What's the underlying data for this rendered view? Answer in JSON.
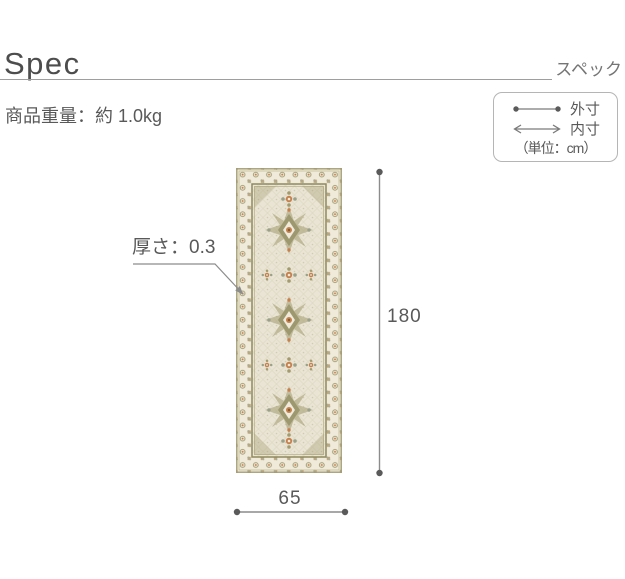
{
  "header": {
    "title": "Spec",
    "subtitle": "スペック"
  },
  "product": {
    "weight": "商品重量：約 1.0kg"
  },
  "legend": {
    "outer": {
      "icon": "outer-dimension-dots-icon",
      "label": "外寸"
    },
    "inner": {
      "icon": "inner-dimension-arrows-icon",
      "label": "内寸"
    },
    "unit": "（単位：cm）"
  },
  "dimensions": {
    "thickness": "厚さ：0.3",
    "height": "180",
    "width": "65"
  },
  "rug_colors": {
    "base_band": "#efead9",
    "field": "#e9e4d4",
    "olive": "#8f8a5e",
    "tan_line": "#a29a73",
    "rosette": "#9a946a",
    "accent_orange": "#c5804d",
    "gray_green": "#9aa08a"
  },
  "ui_colors": {
    "title": "#4d4d4d",
    "subtitle": "#757575",
    "text": "#595959",
    "dim_line": "#8c8c8c",
    "dim_dot": "#5a5a5a",
    "rule": "#9e9e9e",
    "legend_border": "#b5b5b5"
  }
}
